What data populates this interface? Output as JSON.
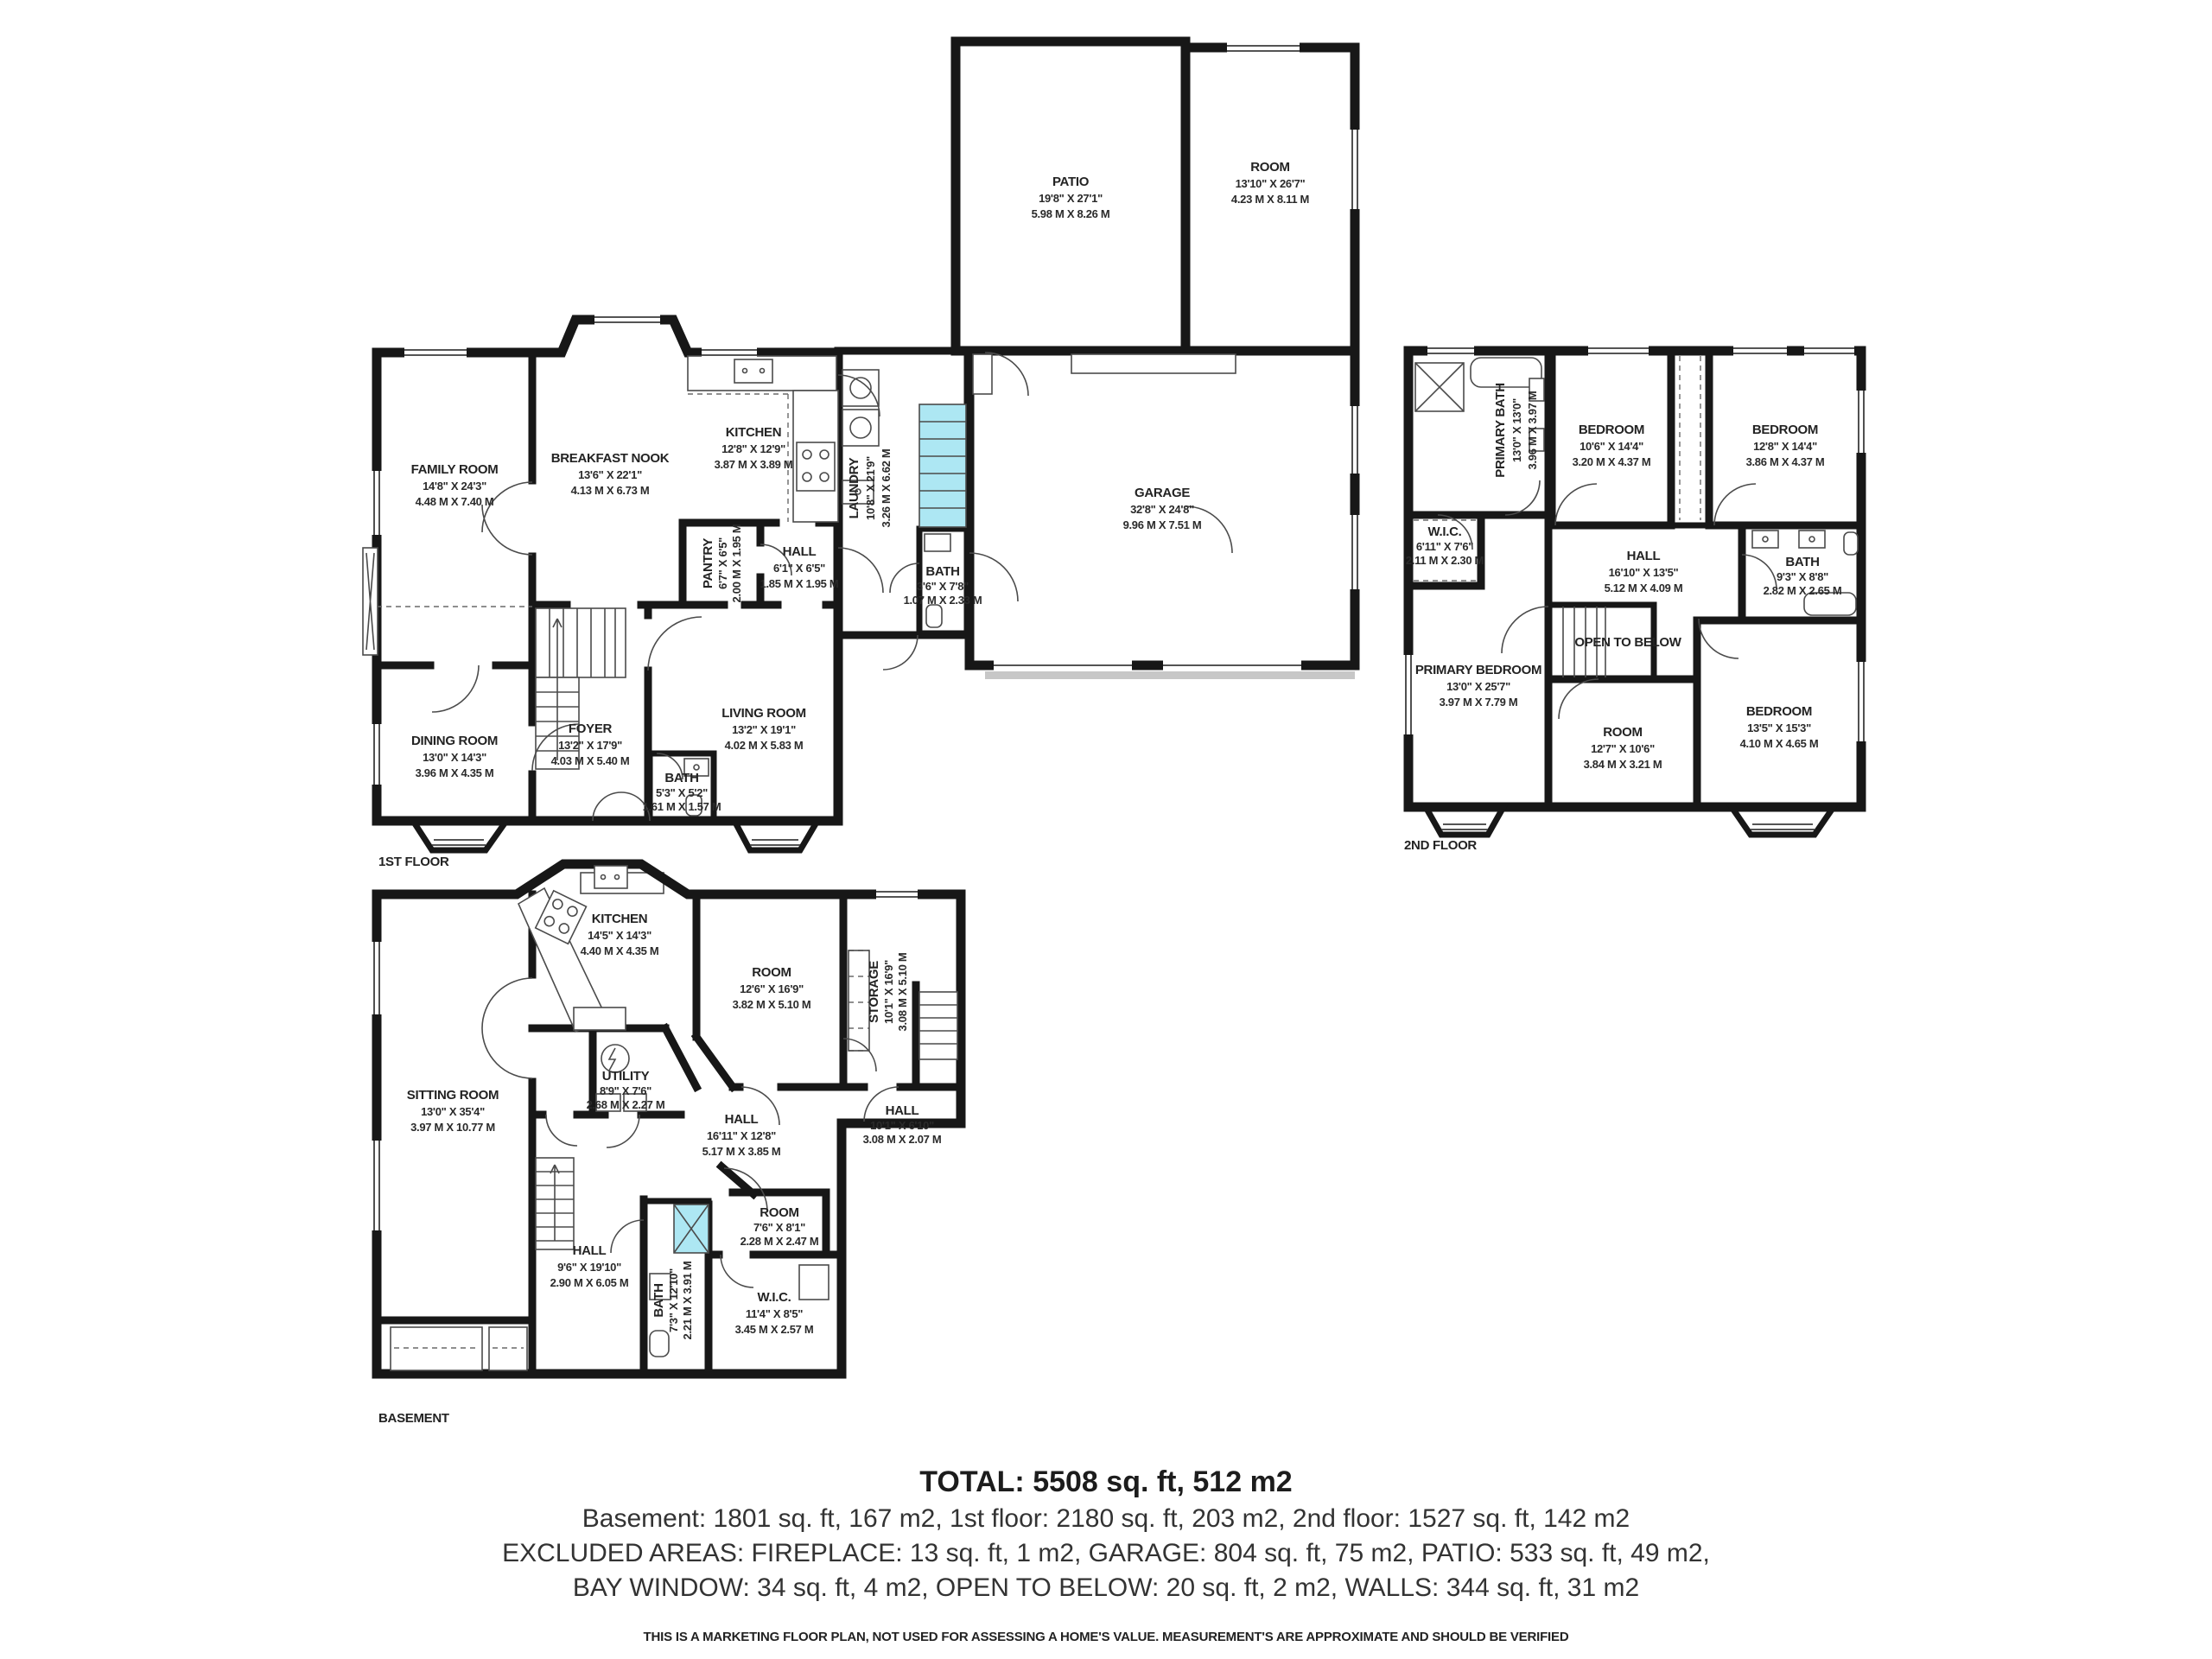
{
  "colors": {
    "wall": "#171717",
    "bath": "#ade7f3",
    "bedroom": "#f2eda3",
    "patio": "#d6efa4",
    "white": "#ffffff"
  },
  "floors": [
    {
      "label": "1ST FLOOR",
      "rooms": [
        {
          "name": "FAMILY ROOM",
          "ft": "14'8\" X 24'3\"",
          "m": "4.48 M X 7.40 M"
        },
        {
          "name": "BREAKFAST NOOK",
          "ft": "13'6\" X 22'1\"",
          "m": "4.13 M X 6.73 M"
        },
        {
          "name": "KITCHEN",
          "ft": "12'8\" X 12'9\"",
          "m": "3.87 M X 3.89 M"
        },
        {
          "name": "PANTRY",
          "ft": "6'7\" X 6'5\"",
          "m": "2.00 M X 1.95 M"
        },
        {
          "name": "HALL",
          "ft": "6'1\" X 6'5\"",
          "m": "1.85 M X 1.95 M"
        },
        {
          "name": "LAUNDRY",
          "ft": "10'8\" X 21'9\"",
          "m": "3.26 M X 6.62 M"
        },
        {
          "name": "BATH",
          "ft": "3'6\" X 7'8\"",
          "m": "1.07 M X 2.33 M"
        },
        {
          "name": "FOYER",
          "ft": "13'2\" X 17'9\"",
          "m": "4.03 M X 5.40 M"
        },
        {
          "name": "DINING ROOM",
          "ft": "13'0\" X 14'3\"",
          "m": "3.96 M X 4.35 M"
        },
        {
          "name": "LIVING ROOM",
          "ft": "13'2\" X 19'1\"",
          "m": "4.02 M X 5.83 M"
        },
        {
          "name": "BATH",
          "ft": "5'3\" X 5'2\"",
          "m": "1.61 M X 1.57 M"
        },
        {
          "name": "GARAGE",
          "ft": "32'8\" X 24'8\"",
          "m": "9.96 M X 7.51 M"
        },
        {
          "name": "PATIO",
          "ft": "19'8\" X 27'1\"",
          "m": "5.98 M X 8.26 M"
        },
        {
          "name": "ROOM",
          "ft": "13'10\" X 26'7\"",
          "m": "4.23 M X 8.11 M"
        }
      ]
    },
    {
      "label": "2ND FLOOR",
      "rooms": [
        {
          "name": "PRIMARY BATH",
          "ft": "13'0\" X 13'0\"",
          "m": "3.96 M X 3.97 M"
        },
        {
          "name": "BEDROOM",
          "ft": "10'6\" X 14'4\"",
          "m": "3.20 M X 4.37 M"
        },
        {
          "name": "BEDROOM",
          "ft": "12'8\" X 14'4\"",
          "m": "3.86 M X 4.37 M"
        },
        {
          "name": "W.I.C.",
          "ft": "6'11\" X 7'6\"",
          "m": "2.11 M X 2.30 M"
        },
        {
          "name": "HALL",
          "ft": "16'10\" X 13'5\"",
          "m": "5.12 M X 4.09 M"
        },
        {
          "name": "BATH",
          "ft": "9'3\" X 8'8\"",
          "m": "2.82 M X 2.65 M"
        },
        {
          "name": "PRIMARY BEDROOM",
          "ft": "13'0\" X 25'7\"",
          "m": "3.97 M X 7.79 M"
        },
        {
          "name": "OPEN TO BELOW",
          "ft": "",
          "m": ""
        },
        {
          "name": "ROOM",
          "ft": "12'7\" X 10'6\"",
          "m": "3.84 M X 3.21 M"
        },
        {
          "name": "BEDROOM",
          "ft": "13'5\" X 15'3\"",
          "m": "4.10 M X 4.65 M"
        }
      ]
    },
    {
      "label": "BASEMENT",
      "rooms": [
        {
          "name": "KITCHEN",
          "ft": "14'5\" X 14'3\"",
          "m": "4.40 M X 4.35 M"
        },
        {
          "name": "ROOM",
          "ft": "12'6\" X 16'9\"",
          "m": "3.82 M X 5.10 M"
        },
        {
          "name": "STORAGE",
          "ft": "10'1\" X 16'9\"",
          "m": "3.08 M X 5.10 M"
        },
        {
          "name": "UTILITY",
          "ft": "8'9\" X 7'6\"",
          "m": "2.68 M X 2.27 M"
        },
        {
          "name": "HALL",
          "ft": "16'11\" X 12'8\"",
          "m": "5.17 M X 3.85 M"
        },
        {
          "name": "HALL",
          "ft": "10'1\" X 6'10\"",
          "m": "3.08 M X 2.07 M"
        },
        {
          "name": "SITTING ROOM",
          "ft": "13'0\" X 35'4\"",
          "m": "3.97 M X 10.77 M"
        },
        {
          "name": "HALL",
          "ft": "9'6\" X 19'10\"",
          "m": "2.90 M X 6.05 M"
        },
        {
          "name": "BATH",
          "ft": "7'3\" X 12'10\"",
          "m": "2.21 M X 3.91 M"
        },
        {
          "name": "ROOM",
          "ft": "7'6\" X 8'1\"",
          "m": "2.28 M X 2.47 M"
        },
        {
          "name": "W.I.C.",
          "ft": "11'4\" X 8'5\"",
          "m": "3.45 M X 2.57 M"
        }
      ]
    }
  ],
  "summary": {
    "total": "TOTAL: 5508 sq. ft, 512 m2",
    "line1": "Basement: 1801 sq. ft, 167 m2, 1st floor: 2180 sq. ft, 203 m2, 2nd floor: 1527 sq. ft, 142 m2",
    "line2": "EXCLUDED AREAS: FIREPLACE: 13 sq. ft, 1 m2, GARAGE: 804 sq. ft, 75 m2, PATIO: 533 sq. ft, 49 m2,",
    "line3": "BAY WINDOW: 34 sq. ft, 4 m2, OPEN TO BELOW: 20 sq. ft, 2 m2, WALLS: 344 sq. ft, 31 m2",
    "disclaimer": "THIS IS A MARKETING FLOOR PLAN, NOT USED FOR ASSESSING A HOME'S VALUE. MEASUREMENT'S ARE APPROXIMATE AND SHOULD BE VERIFIED"
  }
}
